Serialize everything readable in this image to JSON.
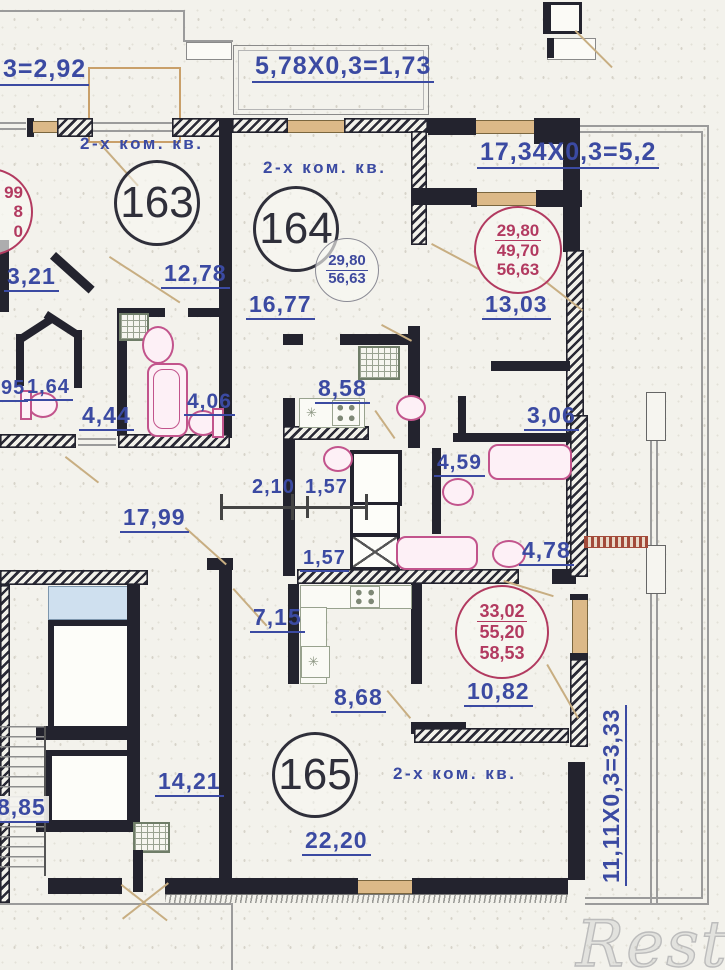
{
  "apartments": [
    {
      "number": "163",
      "type_label": "2-х ком. кв."
    },
    {
      "number": "164",
      "type_label": "2-х ком. кв."
    },
    {
      "number": "165",
      "type_label": "2-х ком. кв."
    }
  ],
  "area_circles": {
    "apt164_inline": {
      "values": [
        "29,80",
        "56,63"
      ]
    },
    "top_right": {
      "values": [
        "29,80",
        "49,70",
        "56,63"
      ]
    },
    "bottom_right": {
      "values": [
        "33,02",
        "55,20",
        "58,53"
      ]
    },
    "left_edge_partial": {
      "values": [
        "99",
        "8",
        "0"
      ]
    }
  },
  "balcony_formulas": {
    "top_left": "3=2,92",
    "top_center": "5,78X0,3=1,73",
    "top_right": "17,34X0,3=5,2",
    "right_vertical": "11,11X0,3=3,33"
  },
  "dimensions": [
    "3,21",
    "12,78",
    "16,77",
    "13,03",
    "95",
    "1,64",
    "4,44",
    "4,06",
    "8,58",
    "3,06",
    "4,59",
    "2,10",
    "1,57",
    "17,99",
    "1,57",
    "4,78",
    "7,15",
    "8,68",
    "10,82",
    "14,21",
    "8,85",
    "22,20"
  ],
  "watermark": "Restate",
  "colors": {
    "dimension_text": "#3b4aa2",
    "area_text": "#b23a60",
    "wall": "#23232e",
    "window": "#dcb988",
    "fixture": "#c2548c"
  }
}
